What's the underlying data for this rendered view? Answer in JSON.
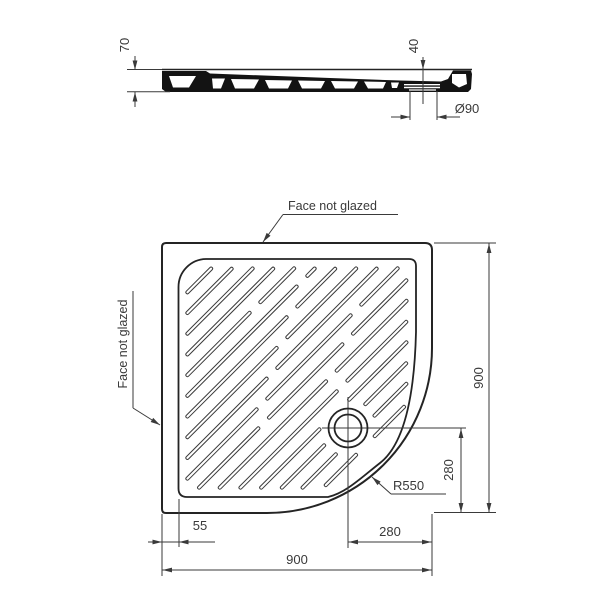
{
  "colors": {
    "ink": "#3a3a3a",
    "outline": "#242424",
    "profile_fill": "#131313",
    "background": "#ffffff"
  },
  "section_view": {
    "height_dim": "70",
    "depth_dim": "40",
    "drain_diameter_dim": "Ø90"
  },
  "plan_view": {
    "top_face_label": "Face not glazed",
    "left_face_label": "Face not glazed",
    "rim_width_dim": "55",
    "drain_offset_horizontal_dim": "280",
    "drain_offset_vertical_dim": "280",
    "overall_width_dim": "900",
    "overall_depth_dim": "900",
    "corner_radius_dim": "R550"
  }
}
